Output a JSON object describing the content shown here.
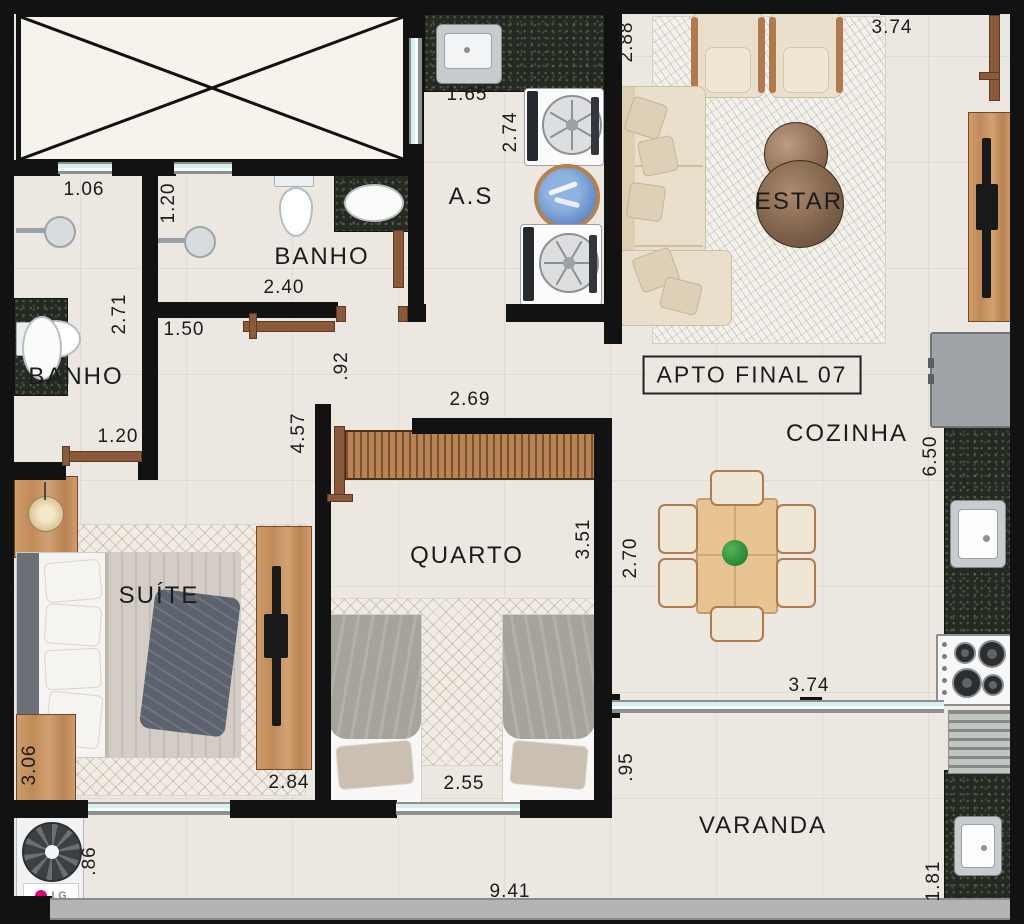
{
  "unit_label": "APTO FINAL 07",
  "rooms": [
    {
      "id": "banho-top",
      "label": "BANHO"
    },
    {
      "id": "banho-left",
      "label": "BANHO"
    },
    {
      "id": "servico",
      "label": "A.S"
    },
    {
      "id": "estar",
      "label": "ESTAR"
    },
    {
      "id": "cozinha",
      "label": "COZINHA"
    },
    {
      "id": "quarto",
      "label": "QUARTO"
    },
    {
      "id": "suite",
      "label": "SUÍTE"
    },
    {
      "id": "varanda",
      "label": "VARANDA"
    }
  ],
  "dimensions": [
    {
      "id": "shower-left-width",
      "value": "1.06"
    },
    {
      "id": "shower-top-width",
      "value": "1.20"
    },
    {
      "id": "banho-top-length",
      "value": "2.40"
    },
    {
      "id": "banho-left-length",
      "value": "2.71"
    },
    {
      "id": "hall-width",
      "value": "1.50"
    },
    {
      "id": "banho-left-door",
      "value": "1.20"
    },
    {
      "id": "wall-jog",
      "value": ".92"
    },
    {
      "id": "suite-length",
      "value": "4.57"
    },
    {
      "id": "quarto-width",
      "value": "2.69"
    },
    {
      "id": "quarto-length",
      "value": "3.51"
    },
    {
      "id": "servico-width",
      "value": "1.65"
    },
    {
      "id": "servico-length",
      "value": "2.74"
    },
    {
      "id": "estar-width",
      "value": "2.88"
    },
    {
      "id": "estar-length",
      "value": "3.74"
    },
    {
      "id": "cozinha-length",
      "value": "6.50"
    },
    {
      "id": "dining-width",
      "value": "2.70"
    },
    {
      "id": "suite-width",
      "value": "3.06"
    },
    {
      "id": "suite-wall",
      "value": "2.84"
    },
    {
      "id": "quarto-beds-span",
      "value": "2.55"
    },
    {
      "id": "varanda-depth-left",
      "value": ".95"
    },
    {
      "id": "varanda-opening",
      "value": "3.74"
    },
    {
      "id": "varanda-length",
      "value": "9.41"
    },
    {
      "id": "tech-area-width",
      "value": ".86"
    },
    {
      "id": "varanda-depth-right",
      "value": "1.81"
    }
  ],
  "appliances": {
    "ac_brand": "LG"
  },
  "colors": {
    "wall": "#121212",
    "floor": "#ece7e0",
    "granite": "#242921",
    "wood": "#c3956a",
    "door": "#8a5a3b",
    "window_glass": "#d6efee",
    "lg_logo_red": "#e5006d",
    "blanket_gray": "#a8a29d",
    "sofa_cream": "#e9dfcb"
  }
}
